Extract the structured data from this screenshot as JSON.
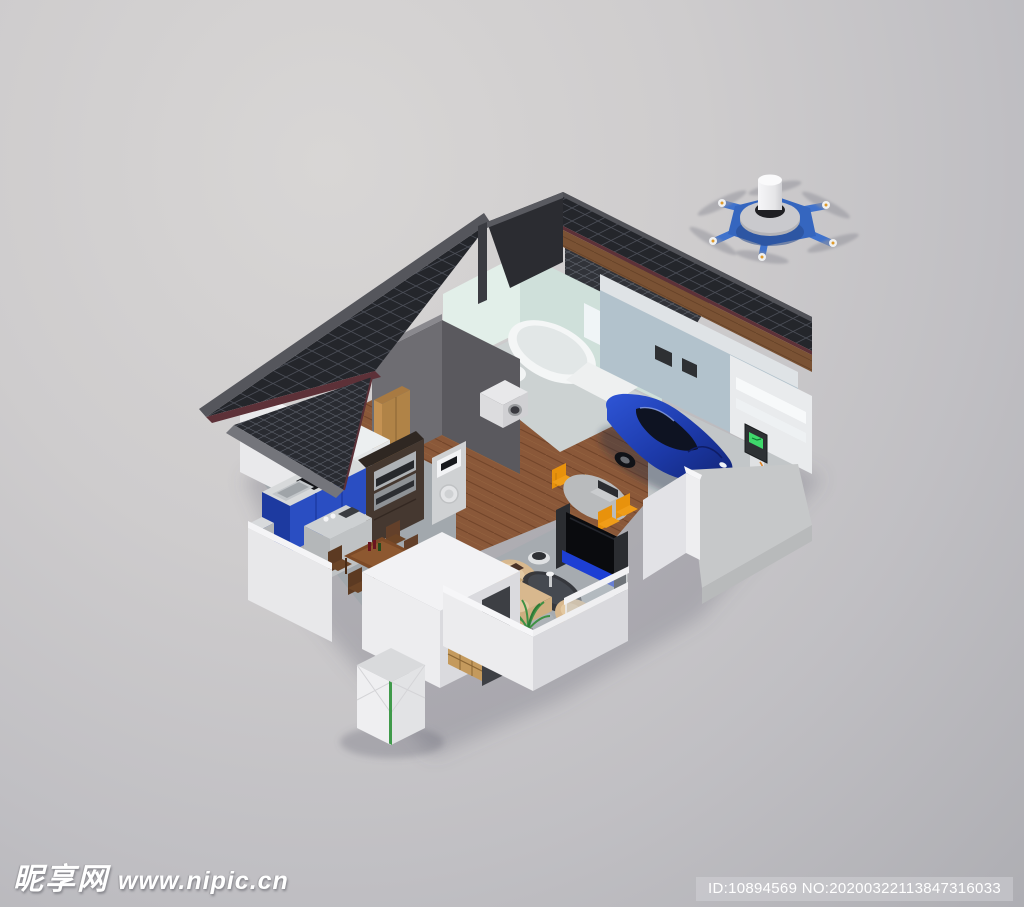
{
  "watermark": {
    "site_name": "昵享网",
    "site_url": "www.nipic.cn"
  },
  "id_bar": {
    "text": "ID:10894569 NO:20200322113847316033"
  },
  "scene": {
    "description": "Isometric 3D cutaway render of a smart home with solar-panel roof, EV garage and a surveillance drone",
    "objects": [
      "hexacopter-drone",
      "solar-panel-roof",
      "bathroom-bathtub",
      "toilet",
      "washing-machine",
      "garage",
      "blue-electric-car",
      "ev-charging-station",
      "driveway-ramp",
      "bedroom-bed",
      "wardrobe",
      "kitchen-blue-cabinets",
      "cooktop",
      "sink",
      "wall-ovens",
      "kitchen-island",
      "heat-pump-unit",
      "dining-table",
      "dining-chairs",
      "study-table",
      "laptop",
      "orange-chairs",
      "tv-with-console",
      "tan-sofa",
      "tan-armchairs",
      "coffee-table",
      "houseplant",
      "robot-vacuum",
      "shoe-shelf",
      "entry-door",
      "outdoor-battery-cube",
      "glass-balustrade"
    ],
    "palette": {
      "background_top": "#d8d6d5",
      "background_bottom": "#aeaeb3",
      "roof_dark": "#24262b",
      "solar_grid": "#4a4d56",
      "roof_edge_maroon": "#5d3138",
      "wall_white": "#ececee",
      "bathroom_mint": "#d8e8e2",
      "garage_wall_blue": "#b2c2cc",
      "wood_floor": "#8a5839",
      "concrete_floor": "#a4aaaf",
      "cabinet_blue": "#2a4ec2",
      "car_blue": "#1e3aa8",
      "drone_blue": "#3566bf",
      "chair_orange": "#e8920c",
      "sofa_tan": "#d8b88e",
      "charger_screen_green": "#3fd86b"
    }
  }
}
